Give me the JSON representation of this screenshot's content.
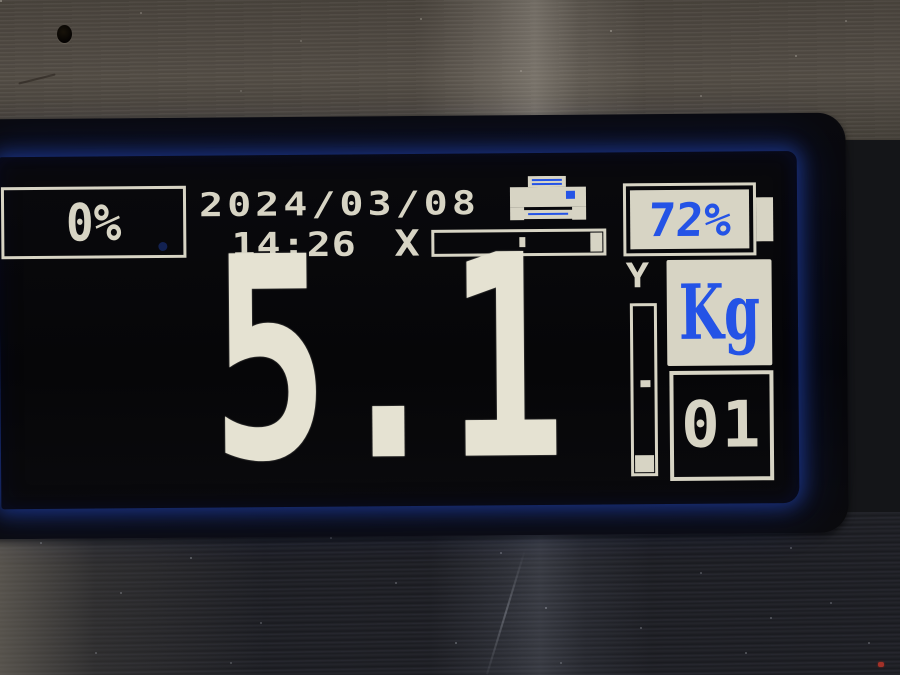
{
  "display": {
    "percent_indicator": "0%",
    "date": "2024/03/08",
    "time": "14:26",
    "transmit_symbol": "X",
    "battery_percent": "72%",
    "weight": "5.1",
    "unit": "Kg",
    "channel": "01",
    "axis_label": "Y"
  },
  "icons": {
    "printer": "printer-icon",
    "battery": "battery-icon",
    "progress_bar": "print-progress-bar",
    "level_gauge": "vertical-level-gauge"
  },
  "colors": {
    "lcd_blue": "#2151e4",
    "lcd_blue_light": "#6e93f5",
    "pixel_cream": "#d7d4c4",
    "bezel_black": "#08080b",
    "metal_top": "#4e4841",
    "metal_bottom": "#1e1f24"
  }
}
